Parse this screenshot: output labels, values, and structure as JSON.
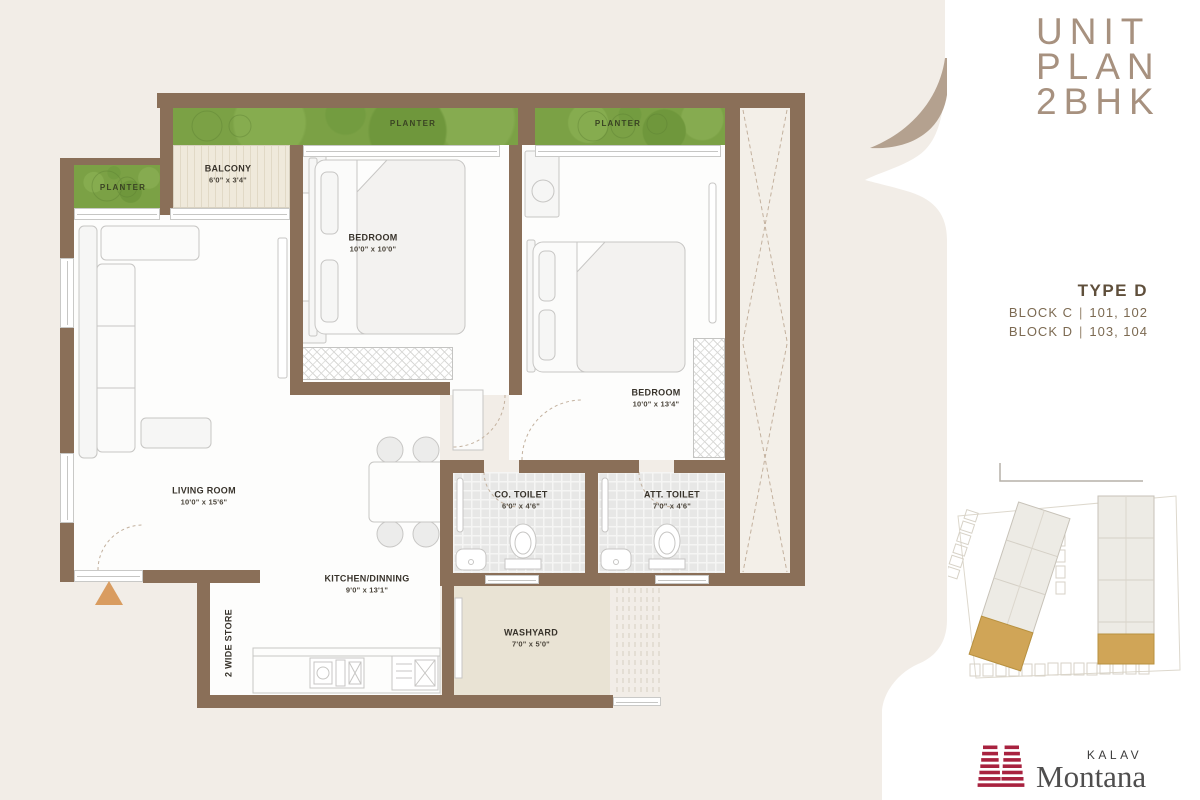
{
  "title": {
    "line1": "UNIT",
    "line2": "PLAN",
    "line3": "2BHK"
  },
  "type_info": {
    "title": "TYPE D",
    "separator": "|",
    "rows": [
      {
        "block": "BLOCK C",
        "units": "101, 102"
      },
      {
        "block": "BLOCK D",
        "units": "103, 104"
      }
    ]
  },
  "brand": {
    "name_top": "KALAV",
    "name_main": "Montana"
  },
  "plan": {
    "rooms": {
      "planter_top_1": {
        "name": "PLANTER"
      },
      "planter_top_2": {
        "name": "PLANTER"
      },
      "planter_left": {
        "name": "PLANTER"
      },
      "balcony": {
        "name": "BALCONY",
        "dim": "6'0\" x 3'4\""
      },
      "bedroom_1": {
        "name": "BEDROOM",
        "dim": "10'0\" x 10'0\""
      },
      "bedroom_2": {
        "name": "BEDROOM",
        "dim": "10'0\" x 13'4\""
      },
      "living_room": {
        "name": "LIVING ROOM",
        "dim": "10'0\" x 15'6\""
      },
      "kitchen": {
        "name": "KITCHEN/DINNING",
        "dim": "9'0\" x 13'1\""
      },
      "co_toilet": {
        "name": "CO. TOILET",
        "dim": "6'0\" x 4'6\""
      },
      "att_toilet": {
        "name": "ATT. TOILET",
        "dim": "7'0\" x 4'6\""
      },
      "washyard": {
        "name": "WASHYARD",
        "dim": "7'0\" x 5'0\""
      },
      "store": {
        "name": "2 WIDE STORE"
      }
    }
  },
  "colors": {
    "background": "#f2ede7",
    "wall": "#8a6f58",
    "planter_green": "#7ba145",
    "accent_arrow": "#d99c60",
    "title_text": "#a7917f",
    "type_text": "#5f4f3b",
    "logo_red": "#a8223f",
    "logo_gray": "#4f4e4e",
    "site_highlight": "#d0a557"
  }
}
